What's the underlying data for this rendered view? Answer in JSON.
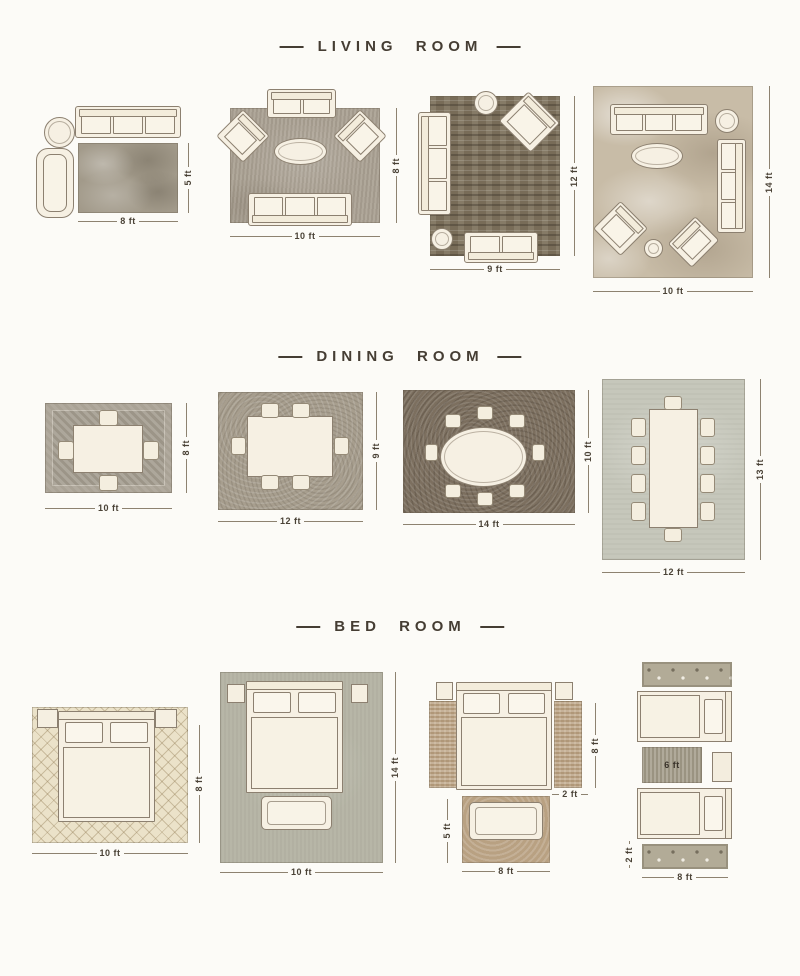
{
  "colors": {
    "background": "#fcfbf7",
    "title_text": "#453d33",
    "dimension_text": "#4a4236",
    "furniture_fill": "#f6f0e3",
    "furniture_outline": "#8c8070"
  },
  "sections": {
    "living": {
      "title": "LIVING ROOM",
      "layouts": {
        "l1": {
          "width": "8 ft",
          "height": "5 ft"
        },
        "l2": {
          "width": "10 ft",
          "height": "8 ft"
        },
        "l3": {
          "width": "9 ft",
          "height": "12 ft"
        },
        "l4": {
          "width": "10 ft",
          "height": "14 ft"
        }
      }
    },
    "dining": {
      "title": "DINING ROOM",
      "layouts": {
        "d1": {
          "width": "10 ft",
          "height": "8 ft"
        },
        "d2": {
          "width": "12 ft",
          "height": "9 ft"
        },
        "d3": {
          "width": "14 ft",
          "height": "10 ft"
        },
        "d4": {
          "width": "12 ft",
          "height": "13 ft"
        }
      }
    },
    "bedroom": {
      "title": "BED ROOM",
      "layouts": {
        "b1": {
          "width": "10 ft",
          "height": "8 ft"
        },
        "b2": {
          "width": "10 ft",
          "height": "14 ft"
        },
        "b3": {
          "width": "8 ft",
          "runner_height": "8 ft",
          "runner_width": "2 ft",
          "foot_rug_height": "5 ft"
        },
        "b4": {
          "width": "8 ft",
          "middle_rug_length": "6 ft",
          "runner_height": "2 ft"
        }
      }
    }
  }
}
